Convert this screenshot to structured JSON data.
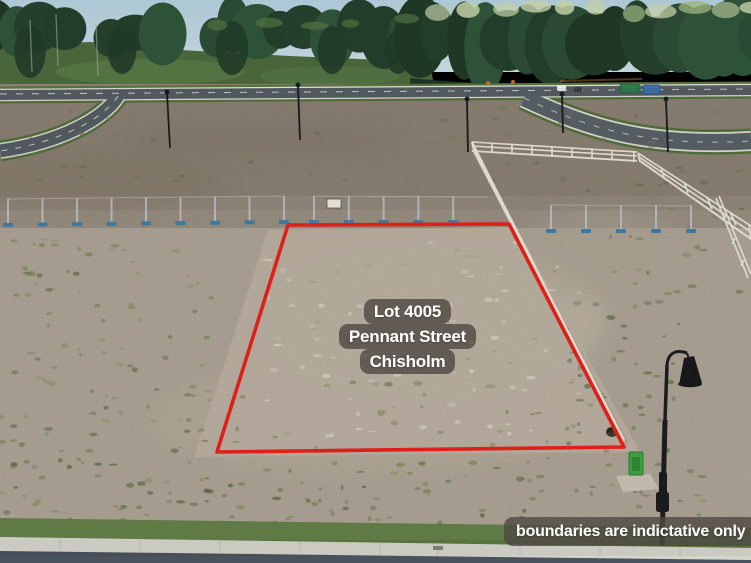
{
  "overlay": {
    "lot_label": {
      "lines": [
        "Lot 4005",
        "Pennant Street",
        "Chisholm"
      ]
    },
    "disclaimer": "boundaries are indictative only"
  },
  "colors": {
    "boundary_red": "#e8160f",
    "label_bg": "rgba(77,73,66,0.8)",
    "label_text": "#ffffff"
  }
}
